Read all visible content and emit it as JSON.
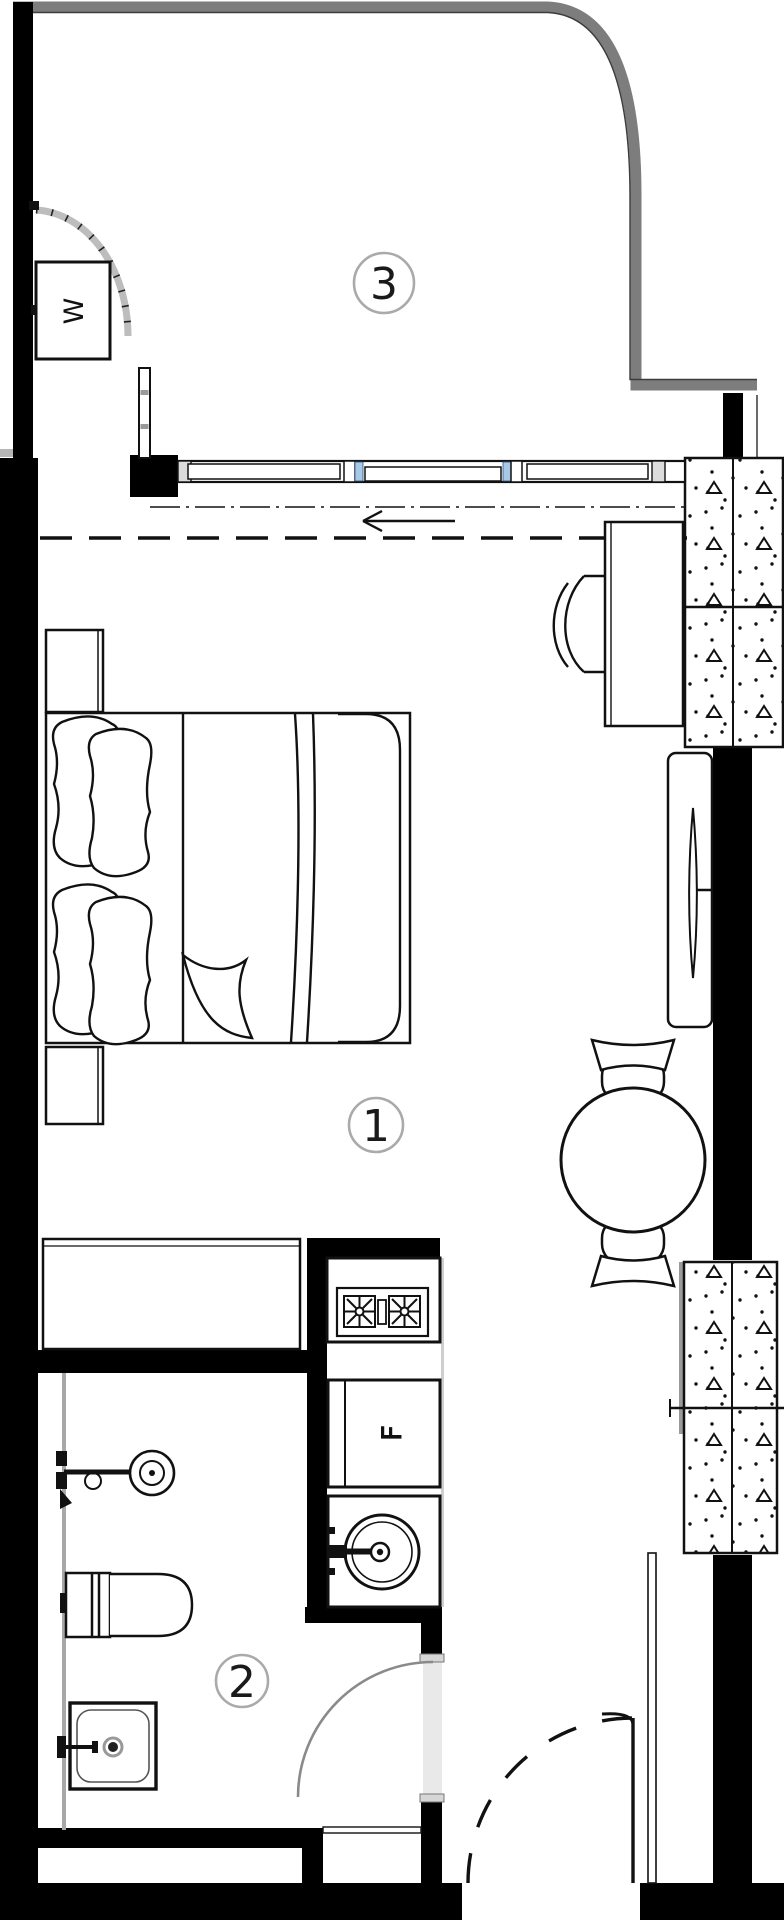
{
  "document": {
    "type": "apartment floor plan",
    "description": "studio apartment plan with balcony, main room and bathroom"
  },
  "rooms": [
    {
      "number": "3",
      "name": "balcony"
    },
    {
      "number": "1",
      "name": "main-room"
    },
    {
      "number": "2",
      "name": "bathroom"
    }
  ],
  "appliances": {
    "washer_label": "W",
    "fridge_label": "F"
  },
  "colors": {
    "background": "#ffffff",
    "wall": "#000000",
    "balcony_outer_wall": "#7d7d7d",
    "door_arc": "#8a8a8a",
    "door_opening": "#e9e9e9",
    "window_glass": "#a8c8e8",
    "label_circle": "#aaaaaa",
    "panel_hatch": "#111111"
  }
}
